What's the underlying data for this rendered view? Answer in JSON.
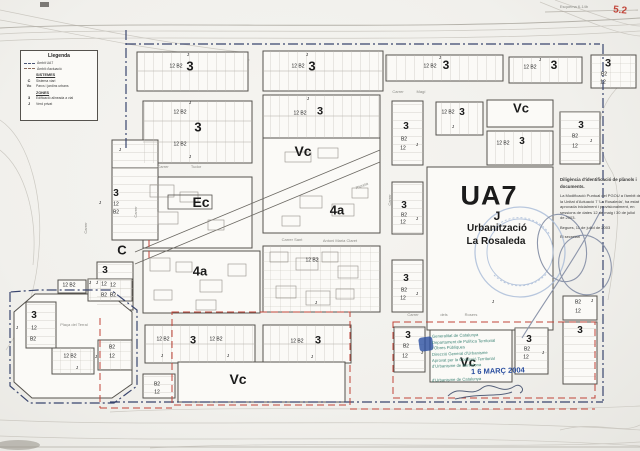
{
  "page": {
    "sheet_note": "Esquema 6-14b",
    "sheet_number": "5.2"
  },
  "colors": {
    "boundary_ambit_ua7": "#39456e",
    "boundary_actuacio": "#c14438",
    "stamp_teal": "#3f8577",
    "stamp_date_blue": "#2b4fa0",
    "sheet_red": "#c14438"
  },
  "legend": {
    "title": "Llegenda",
    "boundary": [
      {
        "symbol": "dash-dot-line",
        "label": "Àmbit UA7"
      },
      {
        "symbol": "dashed-line",
        "label": "Àmbit d'actuació"
      }
    ],
    "sections": [
      {
        "heading": "SISTEMES",
        "items": [
          {
            "code": "C",
            "label": "Sistema viari"
          },
          {
            "code": "Vc",
            "label": "Parcs i jardins urbans"
          }
        ]
      },
      {
        "heading": "ZONES",
        "items": [
          {
            "code": "3",
            "label": "Edificació alineada a vial"
          },
          {
            "code": "J",
            "label": "Verd privat"
          }
        ]
      }
    ]
  },
  "ua7": {
    "code": "UA7",
    "zone": "J",
    "line1": "Urbanització",
    "line2": "La Rosaleda"
  },
  "map": {
    "labels": [
      {
        "t": "Esquema 6-14b",
        "x": 574,
        "y": 7,
        "fs": 4,
        "c": "gray",
        "n": "sheet-reference"
      },
      {
        "t": "5.2",
        "x": 620,
        "y": 11,
        "fs": 10,
        "w": "b",
        "c": "red",
        "r": 6,
        "n": "sheet-number"
      },
      {
        "t": "3",
        "x": 190,
        "y": 66,
        "fs": 13,
        "w": "b",
        "n": "zone-label-3"
      },
      {
        "t": "12 B2",
        "x": 176,
        "y": 67,
        "fs": 5
      },
      {
        "t": "J",
        "x": 188,
        "y": 55,
        "fs": 4.5
      },
      {
        "t": "3",
        "x": 312,
        "y": 66,
        "fs": 13,
        "w": "b",
        "n": "zone-label-3"
      },
      {
        "t": "12 B2",
        "x": 298,
        "y": 67,
        "fs": 5
      },
      {
        "t": "J",
        "x": 307,
        "y": 55,
        "fs": 4.5
      },
      {
        "t": "3",
        "x": 446,
        "y": 65,
        "fs": 12,
        "w": "b",
        "n": "zone-label-3"
      },
      {
        "t": "12 B2",
        "x": 430,
        "y": 67,
        "fs": 5
      },
      {
        "t": "J",
        "x": 440,
        "y": 58,
        "fs": 4.5
      },
      {
        "t": "3",
        "x": 554,
        "y": 65,
        "fs": 12,
        "w": "b",
        "n": "zone-label-3"
      },
      {
        "t": "12 B2",
        "x": 530,
        "y": 68,
        "fs": 5
      },
      {
        "t": "J",
        "x": 540,
        "y": 60,
        "fs": 4.5
      },
      {
        "t": "3",
        "x": 608,
        "y": 64,
        "fs": 11,
        "w": "b",
        "n": "zone-label-3"
      },
      {
        "t": "B2",
        "x": 604,
        "y": 75,
        "fs": 5
      },
      {
        "t": "12",
        "x": 603,
        "y": 83,
        "fs": 5
      },
      {
        "t": "Carrer",
        "x": 398,
        "y": 92,
        "fs": 4,
        "c": "gray",
        "n": "street-name"
      },
      {
        "t": "Magí",
        "x": 421,
        "y": 92,
        "fs": 4,
        "c": "gray",
        "n": "street-name"
      },
      {
        "t": "3",
        "x": 198,
        "y": 127,
        "fs": 13,
        "w": "b",
        "n": "zone-label-3"
      },
      {
        "t": "12 B2",
        "x": 180,
        "y": 113,
        "fs": 5
      },
      {
        "t": "12 B2",
        "x": 180,
        "y": 145,
        "fs": 5
      },
      {
        "t": "J",
        "x": 190,
        "y": 103,
        "fs": 4.5
      },
      {
        "t": "J",
        "x": 190,
        "y": 157,
        "fs": 4.5
      },
      {
        "t": "12 B2",
        "x": 300,
        "y": 114,
        "fs": 5
      },
      {
        "t": "3",
        "x": 320,
        "y": 112,
        "fs": 11,
        "w": "b",
        "n": "zone-label-3"
      },
      {
        "t": "J",
        "x": 308,
        "y": 99,
        "fs": 4.5
      },
      {
        "t": "Vc",
        "x": 303,
        "y": 151,
        "fs": 14,
        "w": "b",
        "n": "zone-label-vc"
      },
      {
        "t": "Riereta",
        "x": 362,
        "y": 186,
        "fs": 4,
        "c": "gray",
        "r": -21,
        "n": "street-name"
      },
      {
        "t": "Ec",
        "x": 201,
        "y": 202,
        "fs": 14,
        "w": "b",
        "n": "zone-label-ec"
      },
      {
        "t": "Carrer",
        "x": 163,
        "y": 167,
        "fs": 4,
        "c": "gray",
        "n": "street-name"
      },
      {
        "t": "Tudor",
        "x": 196,
        "y": 167,
        "fs": 4,
        "c": "gray",
        "n": "street-name"
      },
      {
        "t": "4a",
        "x": 337,
        "y": 210,
        "fs": 13,
        "w": "b",
        "n": "zone-label-4a"
      },
      {
        "t": "4a",
        "x": 200,
        "y": 271,
        "fs": 13,
        "w": "b",
        "n": "zone-label-4a"
      },
      {
        "t": "C",
        "x": 122,
        "y": 250,
        "fs": 13,
        "w": "b",
        "n": "zone-label-c"
      },
      {
        "t": "Carrer Sant",
        "x": 292,
        "y": 240,
        "fs": 4,
        "c": "gray",
        "n": "street-name"
      },
      {
        "t": "Antoni Maria Claret",
        "x": 340,
        "y": 241,
        "fs": 4,
        "c": "gray",
        "n": "street-name"
      },
      {
        "t": "Carrer",
        "x": 390,
        "y": 200,
        "fs": 4,
        "c": "gray",
        "r": -90,
        "n": "street-name"
      },
      {
        "t": "Carrer",
        "x": 136,
        "y": 212,
        "fs": 4,
        "c": "gray",
        "r": -90,
        "n": "street-name"
      },
      {
        "t": "Carrer",
        "x": 86,
        "y": 228,
        "fs": 4,
        "c": "gray",
        "r": -90,
        "n": "street-name"
      },
      {
        "t": "12 B2",
        "x": 312,
        "y": 261,
        "fs": 5
      },
      {
        "t": "J",
        "x": 316,
        "y": 303,
        "fs": 4.5
      },
      {
        "t": "J",
        "x": 120,
        "y": 150,
        "fs": 4.5
      },
      {
        "t": "3",
        "x": 116,
        "y": 194,
        "fs": 10,
        "w": "b",
        "n": "zone-label-3"
      },
      {
        "t": "12",
        "x": 116,
        "y": 205,
        "fs": 5
      },
      {
        "t": "B2",
        "x": 116,
        "y": 213,
        "fs": 5
      },
      {
        "t": "J",
        "x": 100,
        "y": 203,
        "fs": 4.5
      },
      {
        "t": "3",
        "x": 105,
        "y": 271,
        "fs": 10,
        "w": "b",
        "n": "zone-label-3"
      },
      {
        "t": "12",
        "x": 104,
        "y": 285,
        "fs": 5
      },
      {
        "t": "B2",
        "x": 104,
        "y": 296,
        "fs": 5
      },
      {
        "t": "J",
        "x": 90,
        "y": 283,
        "fs": 4.5
      },
      {
        "t": "3",
        "x": 406,
        "y": 127,
        "fs": 10,
        "w": "b",
        "n": "zone-label-3"
      },
      {
        "t": "B2",
        "x": 404,
        "y": 140,
        "fs": 5
      },
      {
        "t": "12",
        "x": 403,
        "y": 149,
        "fs": 5
      },
      {
        "t": "J",
        "x": 417,
        "y": 145,
        "fs": 4.5
      },
      {
        "t": "3",
        "x": 404,
        "y": 206,
        "fs": 10,
        "w": "b",
        "n": "zone-label-3"
      },
      {
        "t": "B2",
        "x": 404,
        "y": 216,
        "fs": 5
      },
      {
        "t": "12",
        "x": 403,
        "y": 223,
        "fs": 5
      },
      {
        "t": "J",
        "x": 417,
        "y": 219,
        "fs": 4.5
      },
      {
        "t": "3",
        "x": 406,
        "y": 279,
        "fs": 10,
        "w": "b",
        "n": "zone-label-3"
      },
      {
        "t": "B2",
        "x": 404,
        "y": 291,
        "fs": 5
      },
      {
        "t": "12",
        "x": 403,
        "y": 299,
        "fs": 5
      },
      {
        "t": "J",
        "x": 417,
        "y": 294,
        "fs": 4.5
      },
      {
        "t": "3",
        "x": 408,
        "y": 336,
        "fs": 10,
        "w": "b",
        "n": "zone-label-3"
      },
      {
        "t": "B2",
        "x": 406,
        "y": 347,
        "fs": 5
      },
      {
        "t": "12",
        "x": 405,
        "y": 357,
        "fs": 5
      },
      {
        "t": "J",
        "x": 422,
        "y": 353,
        "fs": 4.5
      },
      {
        "t": "12 B2",
        "x": 448,
        "y": 113,
        "fs": 5
      },
      {
        "t": "3",
        "x": 462,
        "y": 113,
        "fs": 10,
        "w": "b",
        "n": "zone-label-3"
      },
      {
        "t": "J",
        "x": 453,
        "y": 127,
        "fs": 4.5
      },
      {
        "t": "Vc",
        "x": 521,
        "y": 108,
        "fs": 13,
        "w": "b",
        "n": "zone-label-vc"
      },
      {
        "t": "12 B2",
        "x": 503,
        "y": 144,
        "fs": 5
      },
      {
        "t": "3",
        "x": 522,
        "y": 142,
        "fs": 10,
        "w": "b",
        "n": "zone-label-3"
      },
      {
        "t": "3",
        "x": 581,
        "y": 126,
        "fs": 10,
        "w": "b",
        "n": "zone-label-3"
      },
      {
        "t": "B2",
        "x": 575,
        "y": 137,
        "fs": 5
      },
      {
        "t": "12",
        "x": 575,
        "y": 147,
        "fs": 5
      },
      {
        "t": "J",
        "x": 591,
        "y": 141,
        "fs": 4.5
      },
      {
        "t": "UA7",
        "x": 489,
        "y": 196,
        "fs": 27,
        "w": "b",
        "ls": 1,
        "n": "ua7-label"
      },
      {
        "t": "J",
        "x": 497,
        "y": 216,
        "fs": 12,
        "w": "b",
        "n": "ua7-zone"
      },
      {
        "t": "Urbanització",
        "x": 497,
        "y": 229,
        "fs": 10,
        "w": "b",
        "n": "ua7-subtitle"
      },
      {
        "t": "La Rosaleda",
        "x": 496,
        "y": 242,
        "fs": 10,
        "w": "b",
        "n": "ua7-subtitle"
      },
      {
        "t": "Diligència d'identificació de plànols i",
        "x": 560,
        "y": 180,
        "fs": 4.4,
        "w": "b",
        "c": "ink",
        "a": "l",
        "n": "diligencia-title"
      },
      {
        "t": "documents.",
        "x": 560,
        "y": 187,
        "fs": 4.4,
        "w": "b",
        "c": "ink",
        "a": "l",
        "n": "diligencia-title"
      },
      {
        "t": "La Modificació Puntual del PGOU a l'àmbit de",
        "x": 560,
        "y": 196,
        "fs": 4,
        "c": "ink",
        "a": "l",
        "n": "diligencia-body"
      },
      {
        "t": "la Unitat d'Actuació 7 'La Rosaleda', ha estat",
        "x": 560,
        "y": 201.5,
        "fs": 4,
        "c": "ink",
        "a": "l",
        "n": "diligencia-body"
      },
      {
        "t": "aprovada inicialment i provisionalment, en",
        "x": 560,
        "y": 207,
        "fs": 4,
        "c": "ink",
        "a": "l",
        "n": "diligencia-body"
      },
      {
        "t": "sessions de dates 12 de maig i 30 de juliol",
        "x": 560,
        "y": 212.5,
        "fs": 4,
        "c": "ink",
        "a": "l",
        "n": "diligencia-body"
      },
      {
        "t": "de 2003.",
        "x": 560,
        "y": 218,
        "fs": 4,
        "c": "ink",
        "a": "l",
        "n": "diligencia-body"
      },
      {
        "t": "Begues, 11 de juliol de 2003",
        "x": 560,
        "y": 228,
        "fs": 4,
        "c": "ink",
        "a": "l",
        "n": "diligencia-date"
      },
      {
        "t": "El secretari",
        "x": 560,
        "y": 237,
        "fs": 4,
        "c": "ink",
        "a": "l",
        "n": "diligencia-signatory"
      },
      {
        "t": "B2",
        "x": 578,
        "y": 303,
        "fs": 5
      },
      {
        "t": "12",
        "x": 578,
        "y": 312,
        "fs": 5
      },
      {
        "t": "J",
        "x": 592,
        "y": 301,
        "fs": 4.5
      },
      {
        "t": "3",
        "x": 580,
        "y": 331,
        "fs": 10,
        "w": "b",
        "n": "zone-label-3"
      },
      {
        "t": "12 B2",
        "x": 69,
        "y": 286,
        "fs": 5
      },
      {
        "t": "J",
        "x": 97,
        "y": 283,
        "fs": 4.5
      },
      {
        "t": "12",
        "x": 113,
        "y": 286,
        "fs": 5
      },
      {
        "t": "B2",
        "x": 113,
        "y": 296,
        "fs": 5
      },
      {
        "t": "Plaça del Terral",
        "x": 74,
        "y": 325,
        "fs": 4,
        "c": "gray",
        "n": "plaza-name"
      },
      {
        "t": "3",
        "x": 34,
        "y": 316,
        "fs": 10,
        "w": "b",
        "n": "zone-label-3"
      },
      {
        "t": "J",
        "x": 17,
        "y": 328,
        "fs": 4.5
      },
      {
        "t": "12",
        "x": 34,
        "y": 329,
        "fs": 5
      },
      {
        "t": "B2",
        "x": 33,
        "y": 340,
        "fs": 5
      },
      {
        "t": "12 B2",
        "x": 70,
        "y": 357,
        "fs": 5
      },
      {
        "t": "J",
        "x": 77,
        "y": 368,
        "fs": 4.5
      },
      {
        "t": "B2",
        "x": 112,
        "y": 348,
        "fs": 5
      },
      {
        "t": "12",
        "x": 112,
        "y": 357,
        "fs": 5
      },
      {
        "t": "J",
        "x": 96,
        "y": 357,
        "fs": 4.5
      },
      {
        "t": "12 B2",
        "x": 163,
        "y": 340,
        "fs": 5
      },
      {
        "t": "3",
        "x": 193,
        "y": 341,
        "fs": 11,
        "w": "b",
        "n": "zone-label-3"
      },
      {
        "t": "12 B2",
        "x": 216,
        "y": 340,
        "fs": 5
      },
      {
        "t": "J",
        "x": 162,
        "y": 356,
        "fs": 4.5
      },
      {
        "t": "J",
        "x": 228,
        "y": 356,
        "fs": 4.5
      },
      {
        "t": "12 B2",
        "x": 297,
        "y": 342,
        "fs": 5
      },
      {
        "t": "3",
        "x": 318,
        "y": 341,
        "fs": 11,
        "w": "b",
        "n": "zone-label-3"
      },
      {
        "t": "J",
        "x": 312,
        "y": 357,
        "fs": 4.5
      },
      {
        "t": "Vc",
        "x": 238,
        "y": 379,
        "fs": 14,
        "w": "b",
        "n": "zone-label-vc"
      },
      {
        "t": "B2",
        "x": 157,
        "y": 385,
        "fs": 5
      },
      {
        "t": "12",
        "x": 157,
        "y": 393,
        "fs": 5
      },
      {
        "t": "Carrer",
        "x": 413,
        "y": 315,
        "fs": 4,
        "c": "gray",
        "n": "street-name"
      },
      {
        "t": "dels",
        "x": 444,
        "y": 315,
        "fs": 4,
        "c": "gray",
        "n": "street-name"
      },
      {
        "t": "Rosers",
        "x": 471,
        "y": 315,
        "fs": 4,
        "c": "gray",
        "n": "street-name"
      },
      {
        "t": "J",
        "x": 493,
        "y": 302,
        "fs": 4.5
      },
      {
        "t": "Vc",
        "x": 468,
        "y": 362,
        "fs": 13,
        "w": "b",
        "n": "zone-label-vc"
      },
      {
        "t": "3",
        "x": 529,
        "y": 340,
        "fs": 10,
        "w": "b",
        "n": "zone-label-3"
      },
      {
        "t": "B2",
        "x": 527,
        "y": 350,
        "fs": 5
      },
      {
        "t": "12",
        "x": 526,
        "y": 358,
        "fs": 5
      },
      {
        "t": "J",
        "x": 543,
        "y": 353,
        "fs": 4.5
      },
      {
        "t": "Generalitat de Catalunya",
        "x": 432,
        "y": 336,
        "fs": 4.2,
        "c": "teal",
        "r": -2,
        "a": "l",
        "n": "approval-stamp-line"
      },
      {
        "t": "Departament de Política Territorial",
        "x": 432,
        "y": 342,
        "fs": 4.2,
        "c": "teal",
        "r": -2,
        "a": "l",
        "n": "approval-stamp-line"
      },
      {
        "t": "i Obres Públiques",
        "x": 432,
        "y": 348,
        "fs": 4.2,
        "c": "teal",
        "r": -2,
        "a": "l",
        "n": "approval-stamp-line"
      },
      {
        "t": "Direcció General d'Urbanisme",
        "x": 432,
        "y": 354,
        "fs": 4.2,
        "c": "teal",
        "r": -2,
        "a": "l",
        "n": "approval-stamp-line"
      },
      {
        "t": "Aprovat per la Comissió Territorial",
        "x": 432,
        "y": 360,
        "fs": 4.2,
        "c": "teal",
        "r": -2,
        "a": "l",
        "n": "approval-stamp-line"
      },
      {
        "t": "d'Urbanisme de Barcelona",
        "x": 432,
        "y": 366,
        "fs": 4.2,
        "c": "teal",
        "r": -2,
        "a": "l",
        "n": "approval-stamp-line"
      },
      {
        "t": "1 6 MARÇ 2004",
        "x": 471,
        "y": 371,
        "fs": 7.5,
        "w": "b",
        "c": "blue",
        "r": -2,
        "a": "l",
        "n": "date-stamp"
      },
      {
        "t": "d'Urbanisme de Catalunya",
        "x": 432,
        "y": 380,
        "fs": 4.2,
        "c": "teal",
        "r": -2,
        "a": "l",
        "n": "approval-stamp-line"
      }
    ]
  }
}
